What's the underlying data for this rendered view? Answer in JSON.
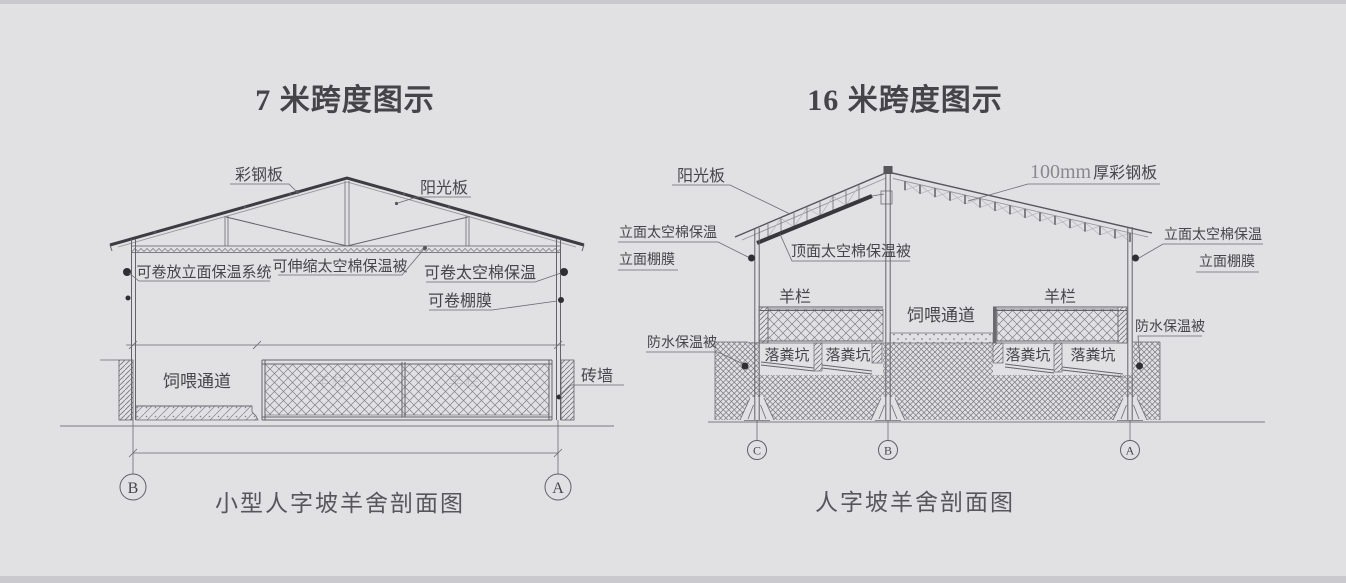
{
  "page": {
    "background": "#e1e1e4",
    "edge_color": "#c9c9ce"
  },
  "left_diagram": {
    "title": "7 米跨度图示",
    "caption": "小型人字坡羊舍剖面图",
    "axis": {
      "left": "B",
      "right": "A"
    },
    "labels": {
      "roof_panel": "彩钢板",
      "sun_panel": "阳光板",
      "facade_system": "可卷放立面保温系统",
      "ceiling_quilt": "可伸缩太空棉保温被",
      "right_insulation": "可卷太空棉保温",
      "right_film": "可卷棚膜",
      "feed_passage": "饲喂通道",
      "brick_wall": "砖墙",
      "pen_faint_left": "羊栏",
      "pen_faint_right": "羊栏"
    }
  },
  "right_diagram": {
    "title": "16 米跨度图示",
    "caption": "人字坡羊舍剖面图",
    "axis": {
      "left": "C",
      "middle": "B",
      "right": "A"
    },
    "labels": {
      "sun_panel": "阳光板",
      "steel_panel_size": "100mm",
      "steel_panel_name": "厚彩钢板",
      "facade_insulation_left": "立面太空棉保温",
      "facade_film_left": "立面棚膜",
      "roof_quilt": "顶面太空棉保温被",
      "facade_insulation_right": "立面太空棉保温",
      "facade_film_right": "立面棚膜",
      "pen_left": "羊栏",
      "pen_right": "羊栏",
      "feed_passage": "饲喂通道",
      "waterproof_left": "防水保温被",
      "waterproof_right": "防水保温被",
      "pit_1": "落粪坑",
      "pit_2": "落粪坑",
      "pit_3": "落粪坑",
      "pit_4": "落粪坑"
    }
  }
}
